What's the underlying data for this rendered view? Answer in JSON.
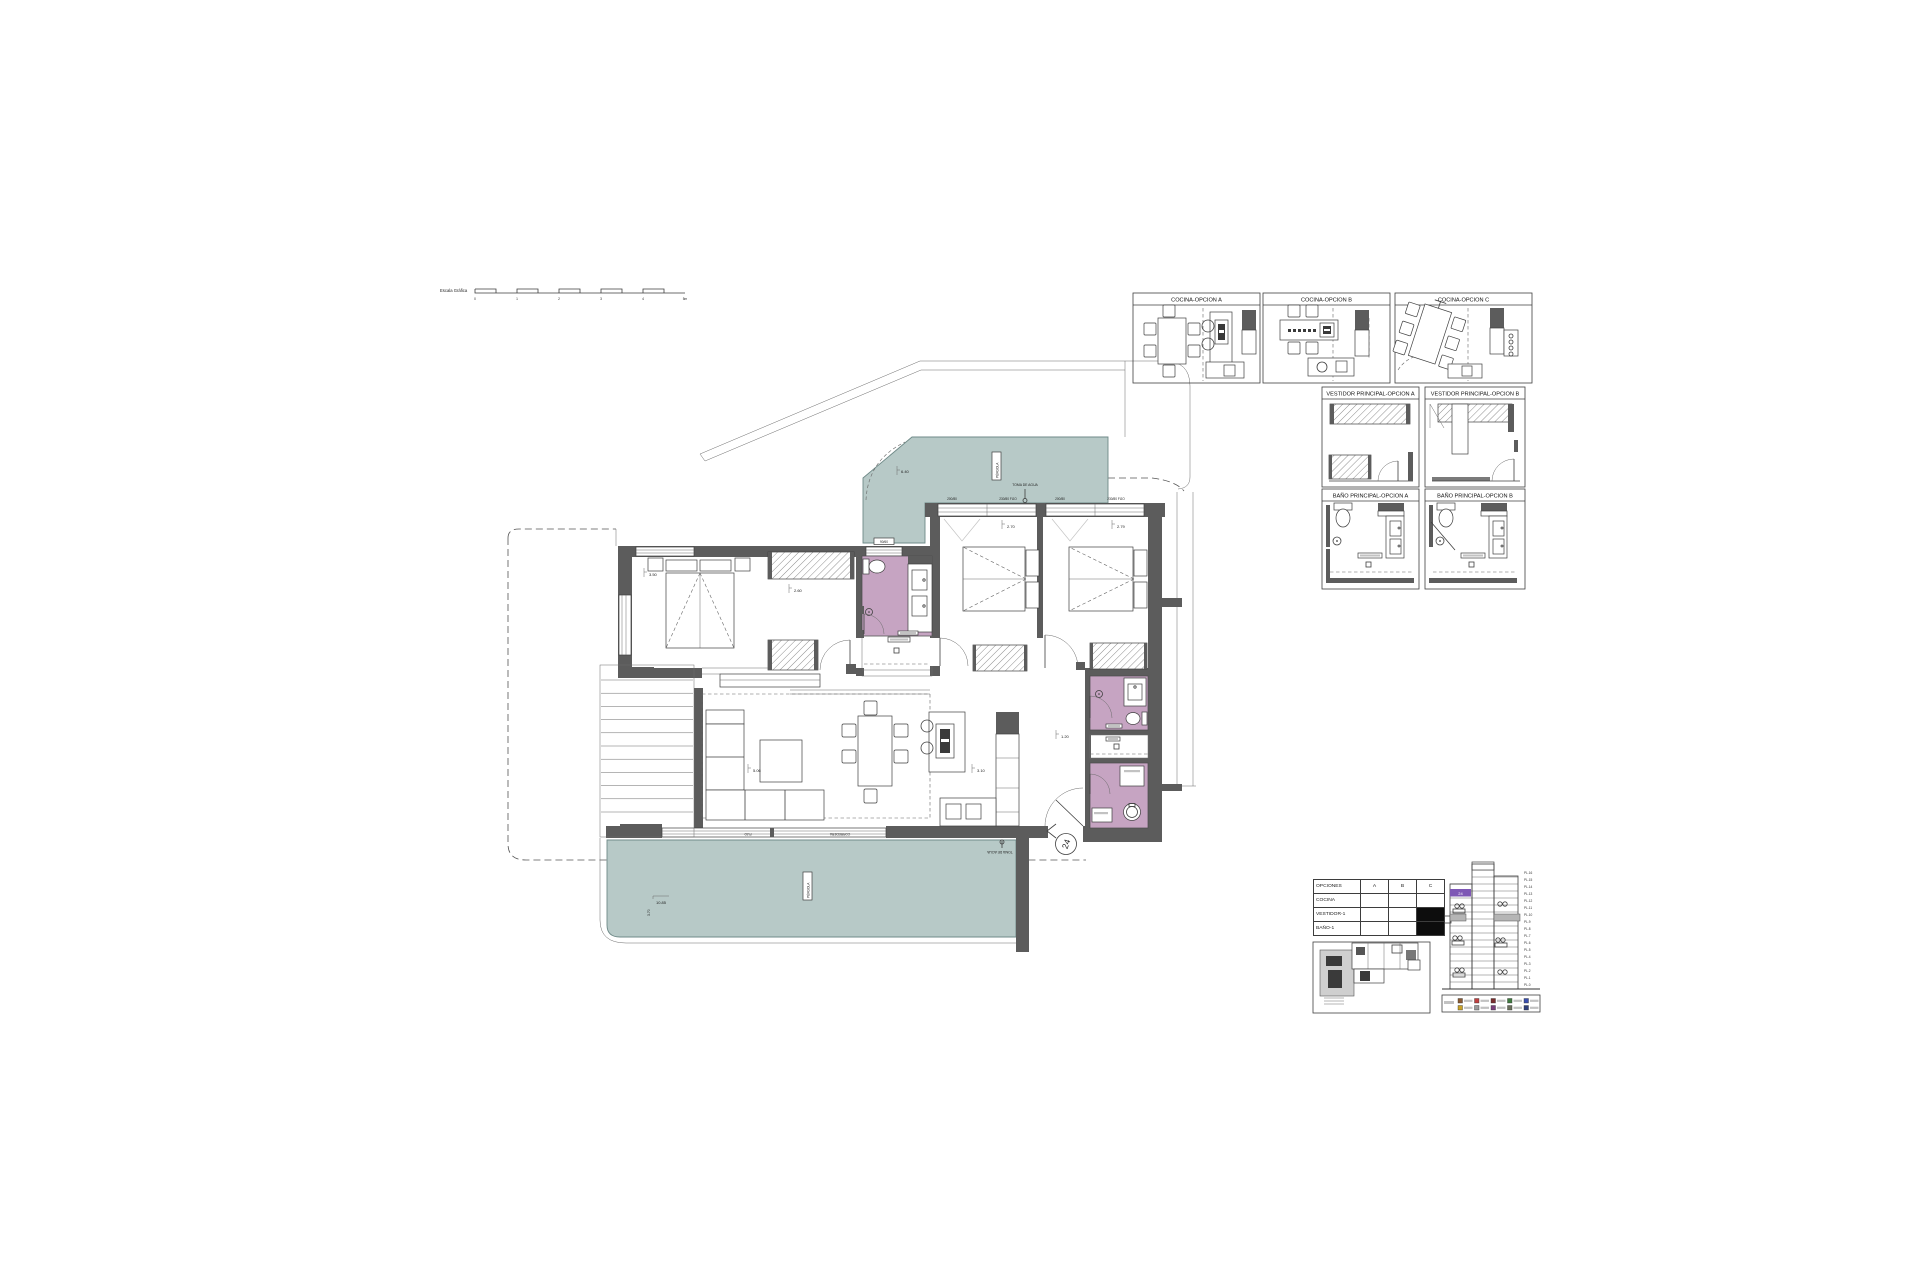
{
  "colors": {
    "teal": "#b7c9c7",
    "purple": "#c6a4c2",
    "wall": "#5c5c5c",
    "section_highlight": "#7e57b5"
  },
  "scalebar": {
    "label": "Escala Gráfica",
    "ticks": [
      "0",
      "1",
      "2",
      "3",
      "4",
      "5m"
    ]
  },
  "plan": {
    "terrace_top": {
      "pergola": "PÉRGOLA",
      "toma": "TOMA DE AGUA",
      "dim": "6.40"
    },
    "terrace_bottom": {
      "pergola": "PÉRGOLA",
      "toma": "TOMA DE AGUA",
      "dim_len": "10.85",
      "dim_dep": "3.70"
    },
    "window_labels": {
      "bed2_a": "200/80",
      "bed2_b": "230/80 FIJO",
      "bed3_a": "200/80",
      "bed3_b": "230/80 FIJO",
      "bath": "90/60"
    },
    "slider_labels": {
      "fixed": "FIJO",
      "slider": "CORREDERA"
    },
    "dims": {
      "master": "3.50",
      "wardrobe": "2.60",
      "bed2": "2.70",
      "bed3": "2.79",
      "living": "5.06",
      "kitchen": "3.10",
      "entry": "1.20"
    },
    "entry_marker": "24"
  },
  "panels": {
    "cocina_a": "COCINA-OPCION A",
    "cocina_b": "COCINA-OPCION B",
    "cocina_c": "COCINA-OPCION C",
    "vestidor_a": "VESTIDOR PRINCIPAL-OPCION A",
    "vestidor_b": "VESTIDOR PRINCIPAL-OPCION B",
    "bano_a": "BAÑO PRINCIPAL-OPCION A",
    "bano_b": "BAÑO PRINCIPAL-OPCION B"
  },
  "options_table": {
    "header": [
      "OPCIONES",
      "A",
      "B",
      "C"
    ],
    "rows": [
      "COCINA",
      "VESTIDOR-1",
      "BAÑO-1"
    ],
    "filled_cells": [
      {
        "row": 1,
        "col": 2
      },
      {
        "row": 2,
        "col": 2
      }
    ]
  },
  "section": {
    "floors": [
      "PL.16",
      "PL.15",
      "PL.14",
      "PL.13",
      "PL.12",
      "PL.11",
      "PL.10",
      "PL.9",
      "PL.8",
      "PL.7",
      "PL.6",
      "PL.5",
      "PL.4",
      "PL.3",
      "PL.2",
      "PL.1",
      "PL.0"
    ],
    "unit_tag": "24",
    "legend": [
      "#8a5a33",
      "#c04040",
      "#7a2e2e",
      "#3f7a3f",
      "#3a4fb0",
      "#c9a227",
      "#9a9a9a",
      "#7a3f7a",
      "#6b705c",
      "#2f3f7a"
    ]
  }
}
